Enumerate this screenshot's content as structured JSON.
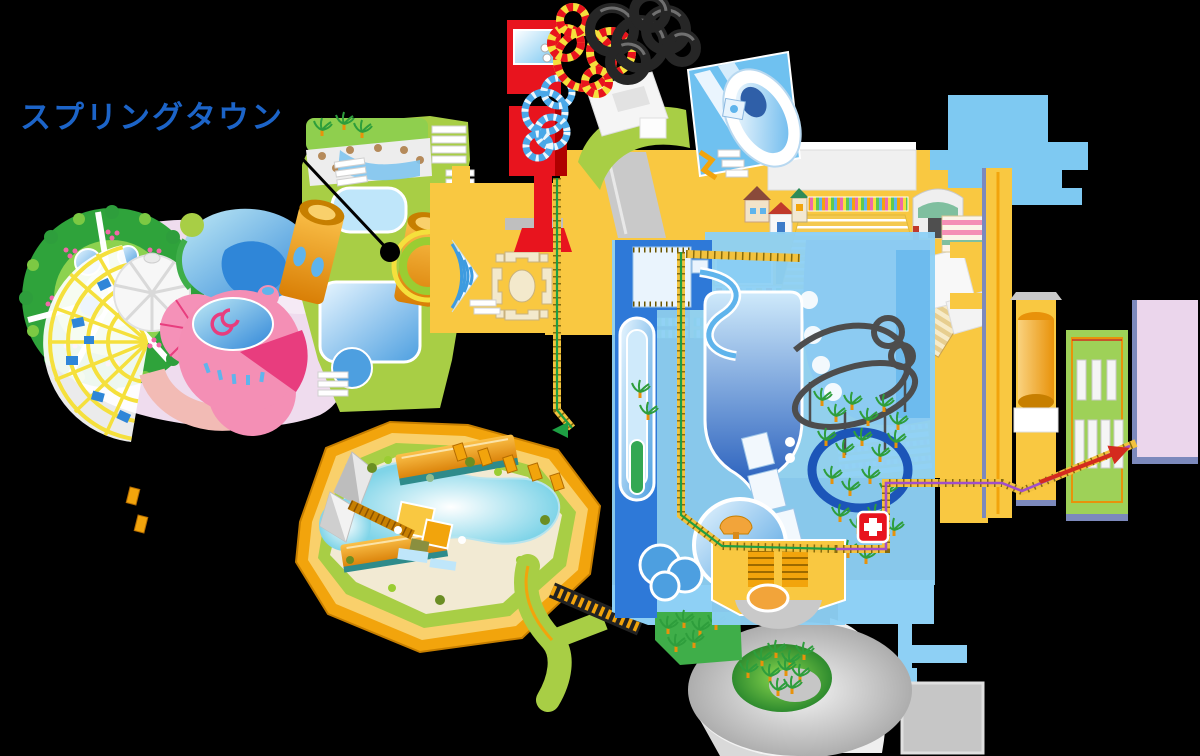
{
  "callout": {
    "label": "スプリングタウン",
    "leader_dot": "black-dot-marker"
  },
  "icons": {
    "first_aid": "first-aid-cross",
    "green_route_arrow": "arrow-left",
    "red_route_arrow": "arrow-up-right",
    "callout_pointer": "leader-line-with-dot"
  },
  "palette": {
    "bg": "#000000",
    "labelBlue": "#1c64c8",
    "leaderLine": "#000000",
    "yellow": "#F9C841",
    "yellowBright": "#F5E03C",
    "orange": "#F2A40C",
    "orangeDark": "#D97F06",
    "lime": "#A8CE45",
    "limeBright": "#C3DE2B",
    "skyPath": "#8ED0F5",
    "skyBlock": "#7EC9F2",
    "poolLight": "#BFE6FA",
    "poolMid": "#4D9FE0",
    "poolDark": "#1C55B8",
    "navySlab": "#2E79D8",
    "greyLight": "#E8E8E8",
    "grey": "#C6C6C6",
    "greyDark": "#9E9E9E",
    "red": "#E8141E",
    "redDeep": "#B00000",
    "tan": "#D9C693",
    "cream": "#F2EAD3",
    "pinkGround": "#EFDCEE",
    "pinkDome": "#F48FB5",
    "pinkDeep": "#E83D7E",
    "salmon": "#F2BBB5",
    "gardenGreen": "#2FA33B",
    "gardenLight": "#8CD24F",
    "lavender": "#EBD6EC",
    "slate": "#7C89BC",
    "trackGrey": "#4D4D4D",
    "routeGreen": "#1E9E43",
    "routePurple": "#A14FC9",
    "routeRed": "#D42B1E",
    "hatchYellow": "#F2C23E",
    "palmGreen": "#2E9E3C",
    "palmTrunk": "#E8920A",
    "firstAidRed": "#E8141E"
  }
}
